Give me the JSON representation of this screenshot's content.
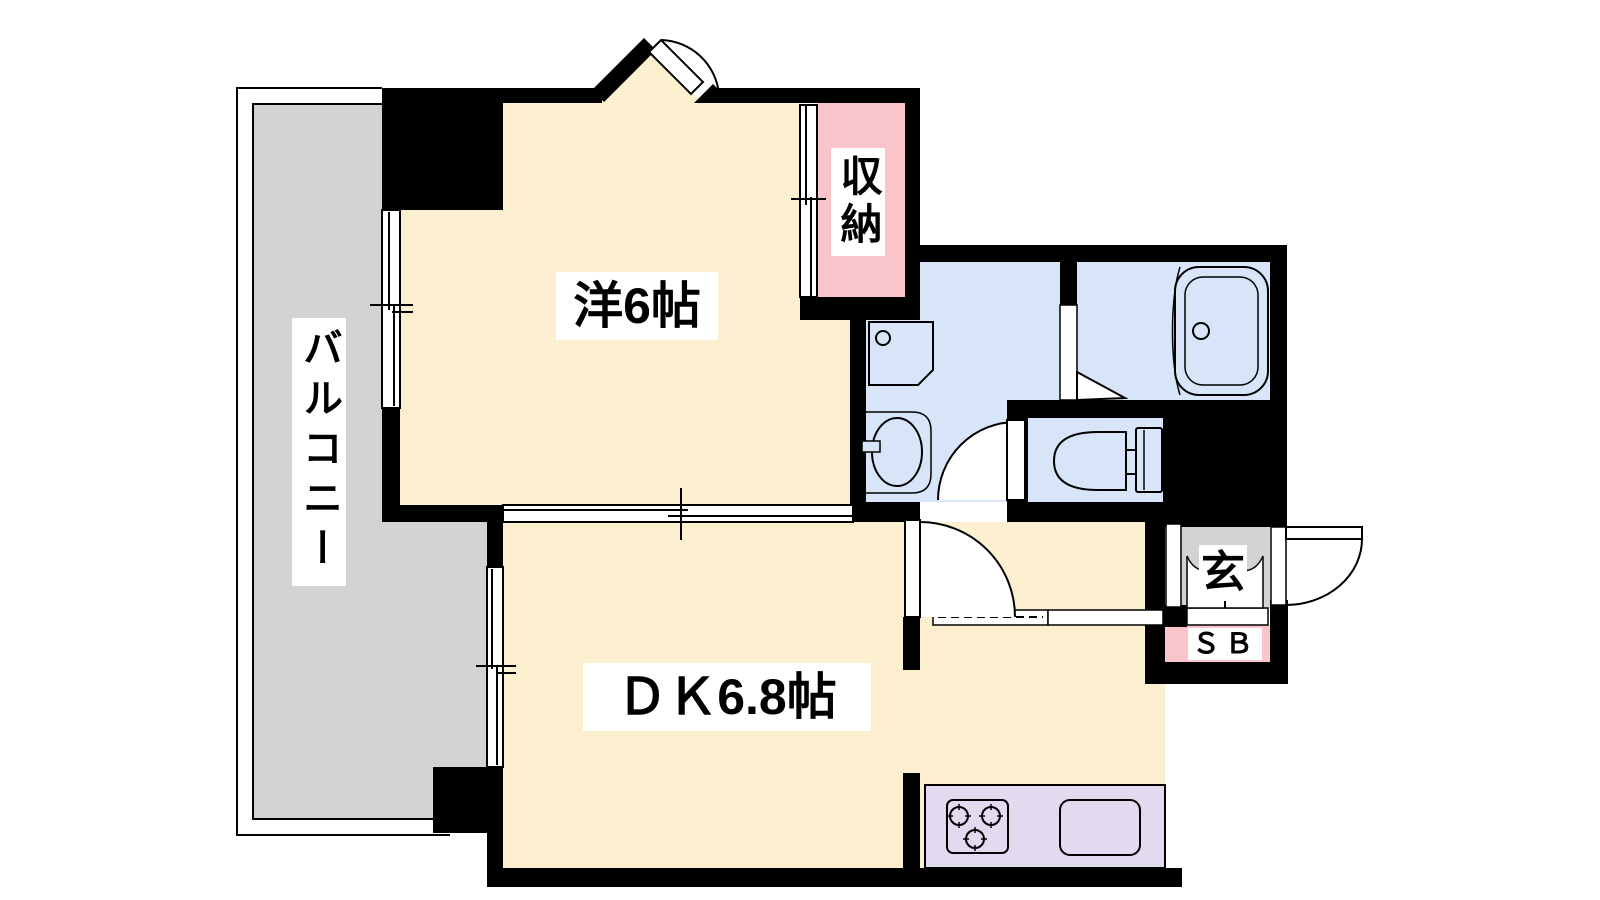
{
  "plan": {
    "type": "apartment-floor-plan",
    "rooms": {
      "balcony": {
        "label": "バルコニー"
      },
      "western_room": {
        "label": "洋6帖"
      },
      "storage": {
        "label": "収納"
      },
      "dining_kitchen": {
        "label": "ＤＫ6.8帖"
      },
      "entrance": {
        "label": "玄"
      },
      "shoe_box": {
        "label": "ＳＢ"
      }
    },
    "colors": {
      "room_floor": "#FCEFD0",
      "wet_area": "#D8E5F8",
      "storage_pink": "#F9C5CB",
      "kitchen_counter": "#E4DAF0",
      "balcony_gray": "#D3D3D3",
      "wall": "#000000",
      "background": "#FFFFFF"
    }
  }
}
